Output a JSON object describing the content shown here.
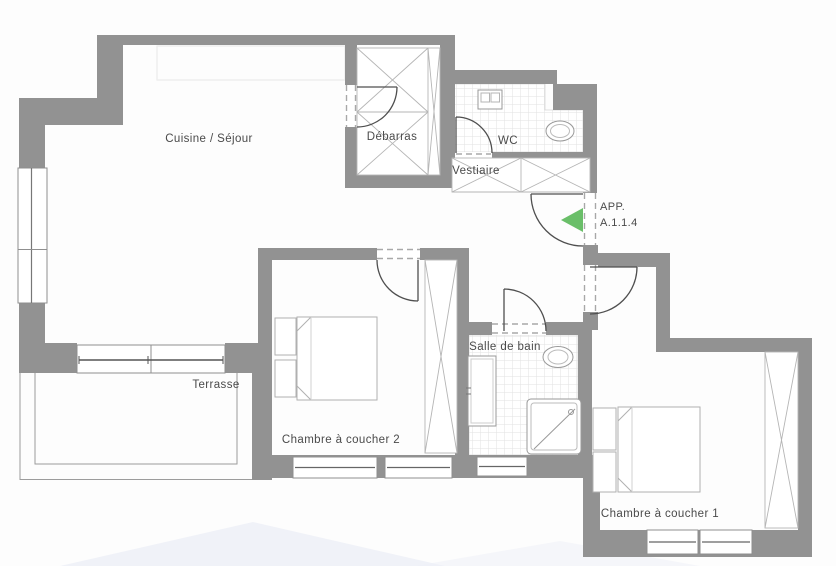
{
  "plan": {
    "apartment": {
      "line1": "APP.",
      "line2": "A.1.1.4"
    },
    "rooms": {
      "cuisine_sejour": {
        "label": "Cuisine / Séjour"
      },
      "debarras": {
        "label": "Débarras"
      },
      "wc": {
        "label": "WC"
      },
      "vestiaire": {
        "label": "Vestiaire"
      },
      "terrasse": {
        "label": "Terrasse"
      },
      "chambre2": {
        "label": "Chambre à coucher 2"
      },
      "salle_de_bain": {
        "label": "Salle de bain"
      },
      "chambre1": {
        "label": "Chambre à coucher 1"
      }
    },
    "icons": [
      "entrance-arrow-icon",
      "door-swing-icon",
      "window-icon",
      "sliding-door-icon",
      "bed-icon",
      "nightstand-icon",
      "wardrobe-icon",
      "closet-icon",
      "toilet-icon",
      "sink-icon",
      "vanity-icon",
      "shower-icon"
    ],
    "colors": {
      "wall": "#929292",
      "entrance_arrow": "#6abf69",
      "tile_line": "#e2e2e2",
      "text": "#4a4a4a",
      "watermark": "#e9edf6"
    }
  }
}
